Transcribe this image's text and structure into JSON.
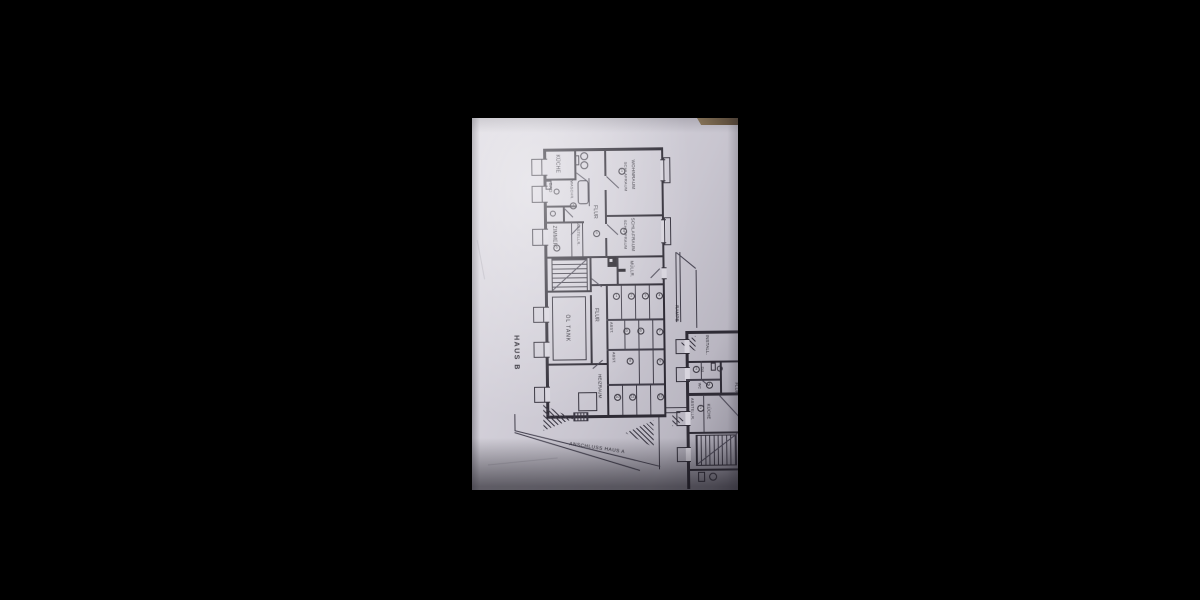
{
  "scene": {
    "background": "#000000",
    "paper_color": "#cfccd5",
    "ink_color": "#2e2b35",
    "table_edge_color": "#8a7458"
  },
  "plan": {
    "title": "HAUS B",
    "annotation": "ANSCHLUSS HAUS A",
    "upper_rooms": {
      "kueche": "KÜCHE",
      "bad": "BAD",
      "waschraum": "WASCHR.",
      "zimmer": "ZIMMER",
      "abstellraum": "ABSTELLR.",
      "flur": "FLUR",
      "wohnraum": "WOHNRAUM",
      "wohnraum_sub": "SCHLAFRAUM",
      "schlafraum": "SCHLAFRAUM",
      "schlafraum_sub": "SCHLAFRAUM",
      "num_wohnraum": "1",
      "num_schlafraum": "1",
      "num_zimmer": "6",
      "num_flur": "5",
      "num_wc": "7"
    },
    "basement": {
      "muellraum": "MÜLLR.",
      "oeltank": "ÖL TANK",
      "flur": "FLUR",
      "abst_row2": "ABST.",
      "abst_row3": "ABST.",
      "heizraum": "HEIZRAUM",
      "cells": [
        "1",
        "2",
        "3",
        "4",
        "5",
        "6",
        "7",
        "8",
        "9",
        "10",
        "11",
        "12"
      ]
    },
    "exterior": {
      "rampe": "RAMPE"
    },
    "haus_a": {
      "install": "INSTALL.",
      "du": "DU",
      "wc": "WC",
      "abstellraum": "ABSTELLR.",
      "kueche": "KÜCHE",
      "flur": "FLUR",
      "num_abstell": "2",
      "num_bad1": "3",
      "num_bad2": "4"
    }
  }
}
